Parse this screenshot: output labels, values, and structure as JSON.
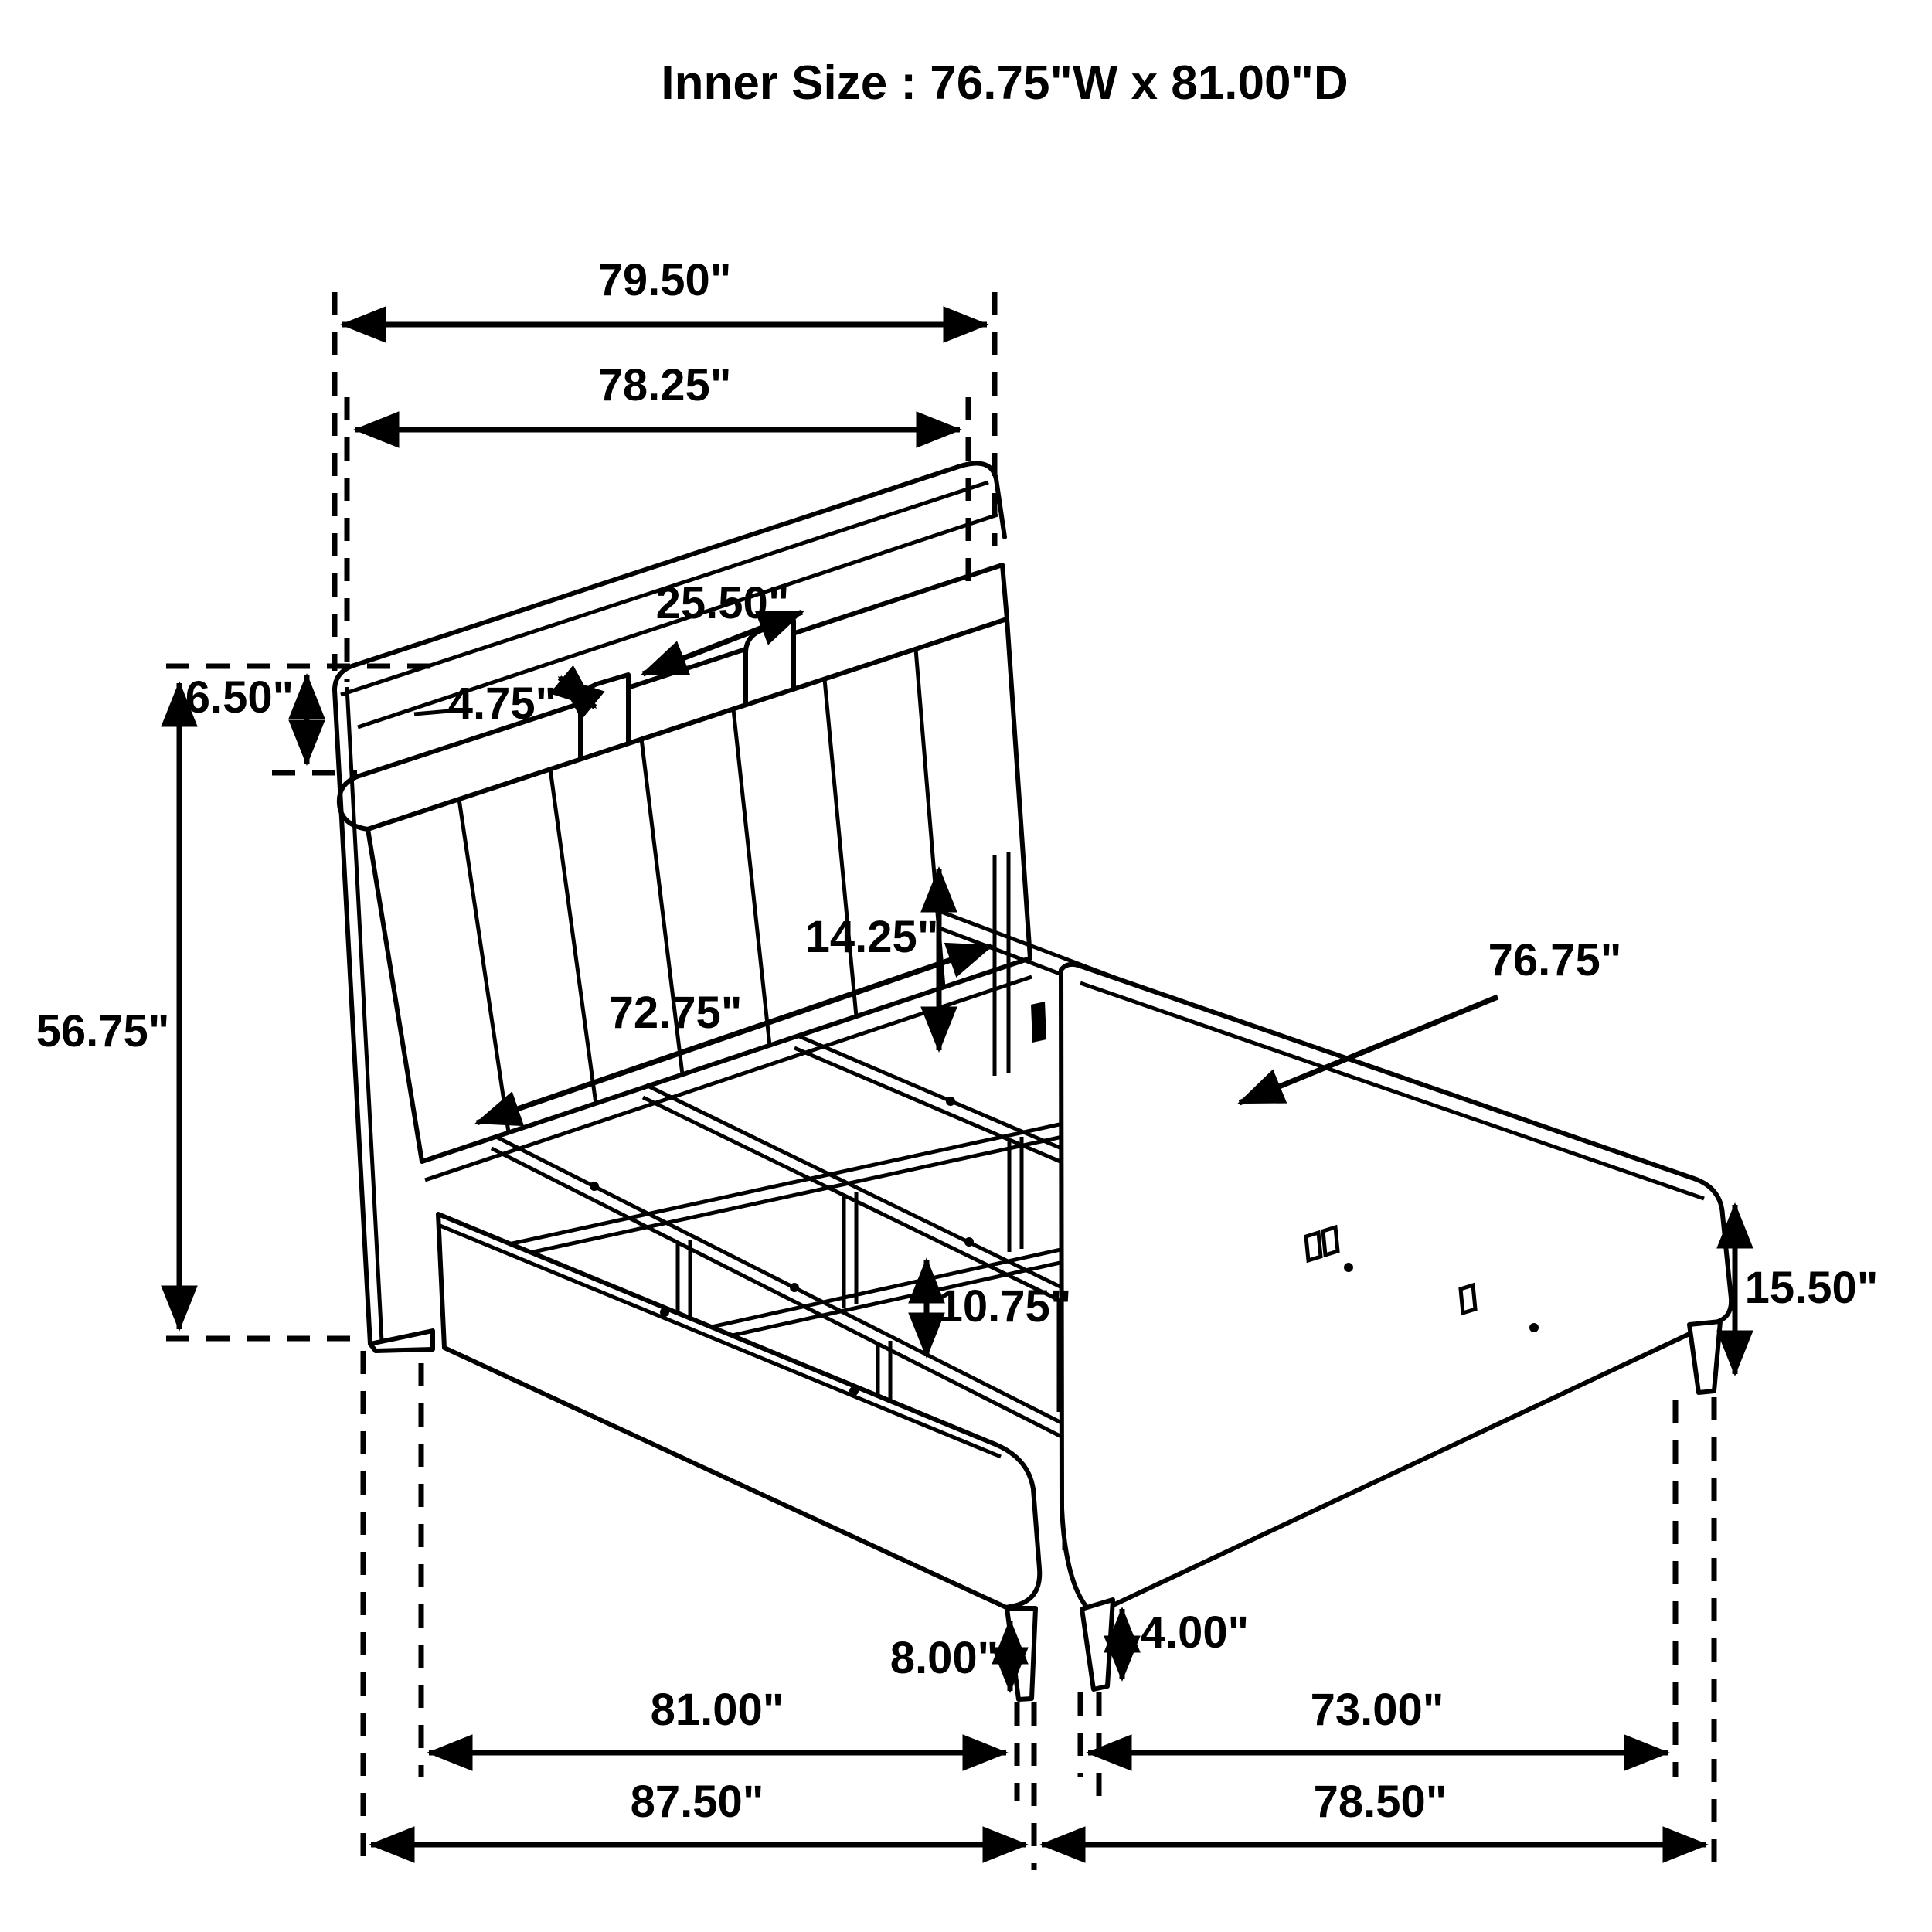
{
  "title": "Inner Size : 76.75\"W x 81.00\"D",
  "diagram": {
    "kind": "dimensioned furniture line drawing",
    "subject": "bed frame with bookcase headboard, slat support rails and footboard",
    "units": "inches",
    "line_color": "#000000",
    "background_color": "#ffffff"
  },
  "dims": {
    "d79_50": {
      "label": "79.50\"",
      "inches": 79.5,
      "orientation": "horizontal"
    },
    "d78_25": {
      "label": "78.25\"",
      "inches": 78.25,
      "orientation": "horizontal"
    },
    "d25_50": {
      "label": "25.50\"",
      "inches": 25.5,
      "orientation": "diagonal"
    },
    "d4_75": {
      "label": "4.75\"",
      "inches": 4.75,
      "orientation": "diagonal"
    },
    "d6_50": {
      "label": "6.50\"",
      "inches": 6.5,
      "orientation": "vertical"
    },
    "d56_75": {
      "label": "56.75\"",
      "inches": 56.75,
      "orientation": "vertical"
    },
    "d14_25": {
      "label": "14.25\"",
      "inches": 14.25,
      "orientation": "vertical"
    },
    "d72_75": {
      "label": "72.75\"",
      "inches": 72.75,
      "orientation": "diagonal"
    },
    "d76_75": {
      "label": "76.75\"",
      "inches": 76.75,
      "orientation": "leader"
    },
    "d10_75": {
      "label": "10.75\"",
      "inches": 10.75,
      "orientation": "vertical"
    },
    "d15_50": {
      "label": "15.50\"",
      "inches": 15.5,
      "orientation": "vertical"
    },
    "d8_00": {
      "label": "8.00\"",
      "inches": 8.0,
      "orientation": "vertical"
    },
    "d4_00": {
      "label": "4.00\"",
      "inches": 4.0,
      "orientation": "vertical"
    },
    "d81_00": {
      "label": "81.00\"",
      "inches": 81.0,
      "orientation": "horizontal"
    },
    "d73_00": {
      "label": "73.00\"",
      "inches": 73.0,
      "orientation": "horizontal"
    },
    "d87_50": {
      "label": "87.50\"",
      "inches": 87.5,
      "orientation": "horizontal"
    },
    "d78_50": {
      "label": "78.50\"",
      "inches": 78.5,
      "orientation": "horizontal"
    }
  }
}
